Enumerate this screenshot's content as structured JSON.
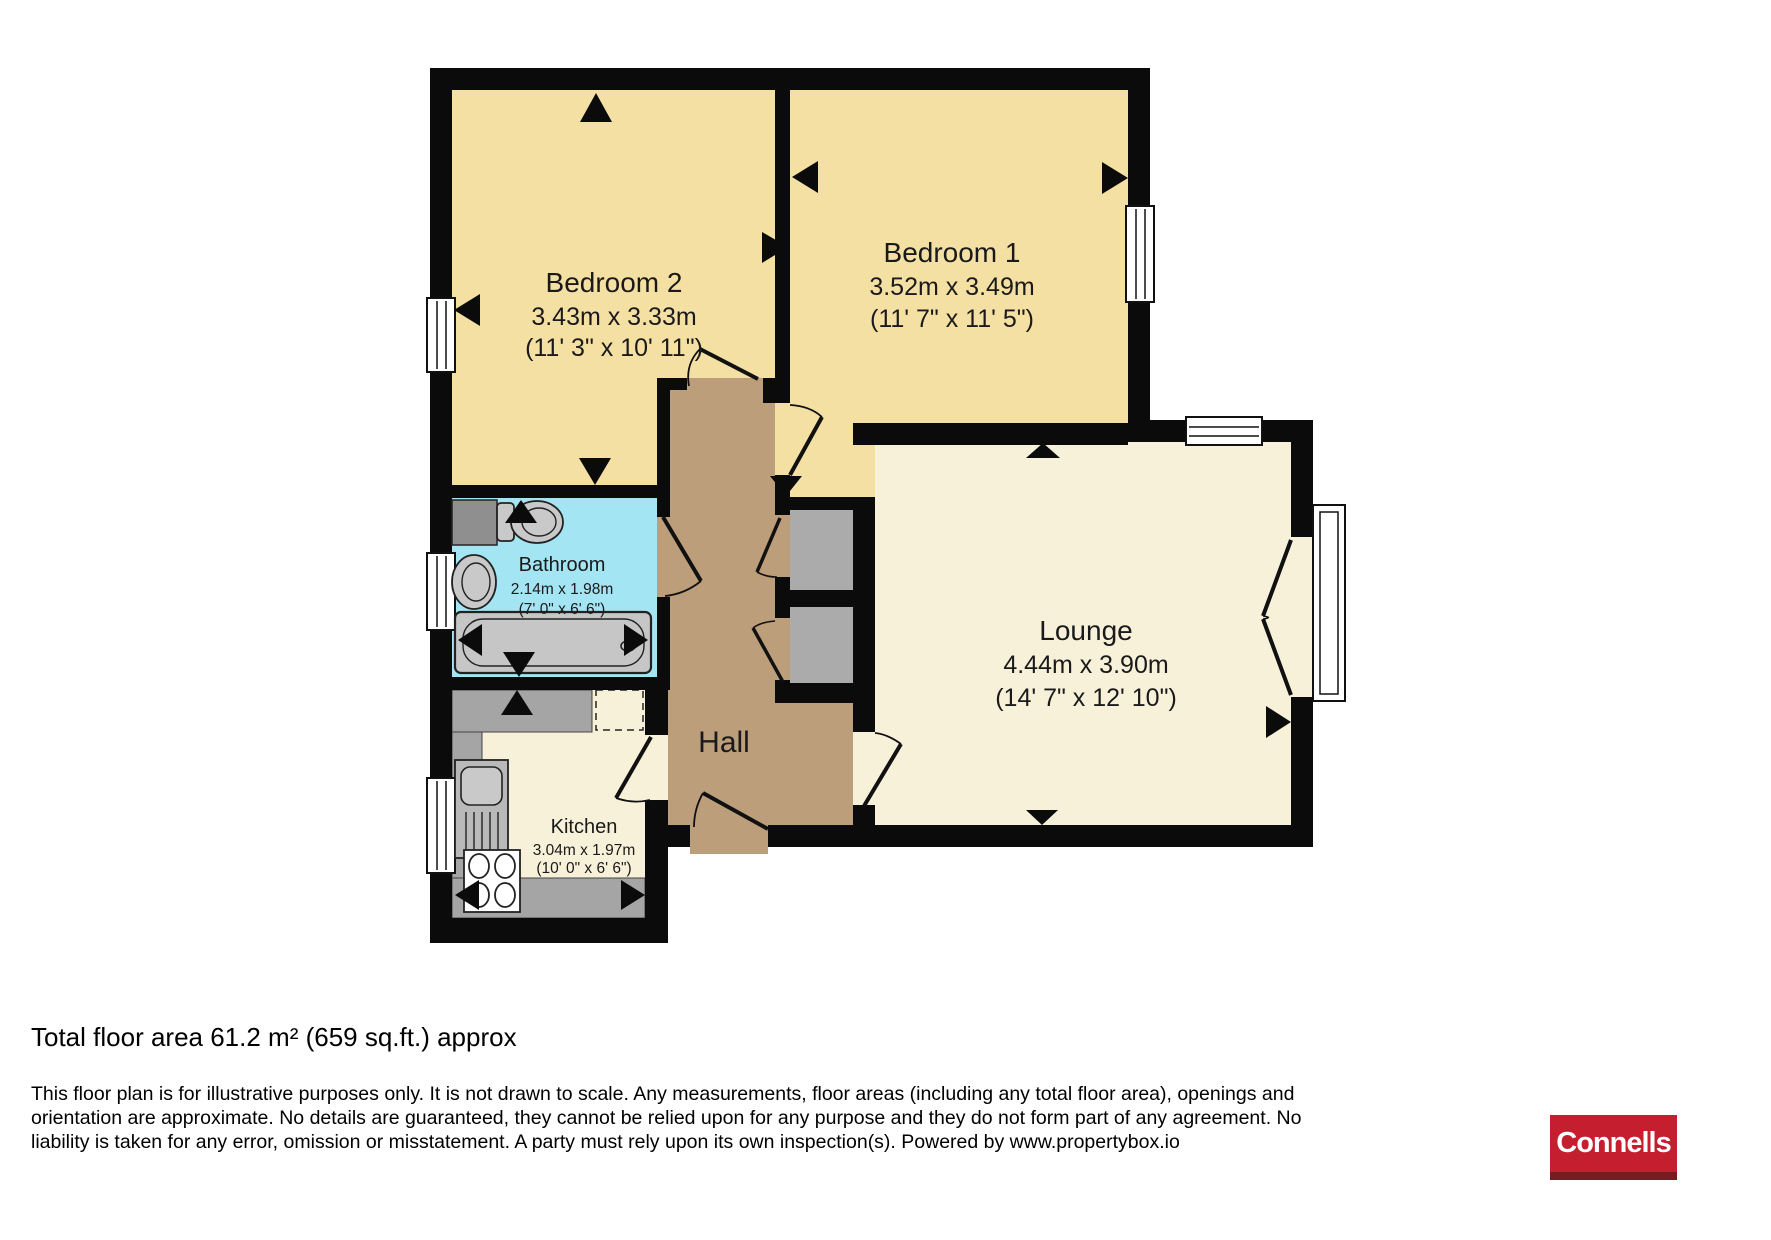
{
  "rooms": {
    "bedroom2": {
      "name": "Bedroom 2",
      "metric": "3.43m x 3.33m",
      "imperial": "(11' 3\" x 10' 11\")"
    },
    "bedroom1": {
      "name": "Bedroom 1",
      "metric": "3.52m x 3.49m",
      "imperial": "(11' 7\" x 11' 5\")"
    },
    "bathroom": {
      "name": "Bathroom",
      "metric": "2.14m x 1.98m",
      "imperial": "(7' 0\" x 6' 6\")"
    },
    "kitchen": {
      "name": "Kitchen",
      "metric": "3.04m x 1.97m",
      "imperial": "(10' 0\" x 6' 6\")"
    },
    "lounge": {
      "name": "Lounge",
      "metric": "4.44m x 3.90m",
      "imperial": "(14' 7\" x 12' 10\")"
    },
    "hall": {
      "name": "Hall"
    }
  },
  "footer": {
    "total_area": "Total floor area 61.2 m² (659 sq.ft.) approx",
    "disclaimer_line1": "This floor plan is for illustrative purposes only. It is not drawn to scale. Any measurements, floor areas (including any total floor area), openings and",
    "disclaimer_line2": "orientation are approximate. No details are guaranteed, they cannot be relied upon for any purpose and they do not form part of any agreement. No",
    "disclaimer_line3": "liability is taken for any error, omission or misstatement. A party must rely upon its own inspection(s). Powered by www.propertybox.io"
  },
  "branding": {
    "logo_text": "Connells"
  },
  "colors": {
    "wall": "#0b0b0b",
    "bedroom_fill": "#F5E0A4",
    "cream_fill": "#F8F1DA",
    "bathroom_fill": "#A3E5F3",
    "hall_fill": "#BD9E7B",
    "closet_gray": "#ABABAB",
    "counter_gray": "#A5A5A5",
    "fixture_gray": "#C6C6C6",
    "logo_red": "#C41E2F",
    "logo_dark_red": "#7A1B22"
  }
}
